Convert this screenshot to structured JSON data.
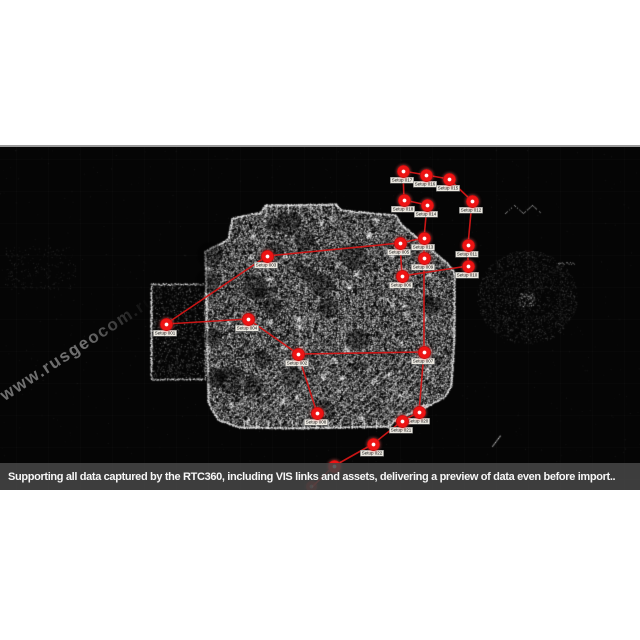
{
  "watermark": {
    "text": "www.rusgeocom.ru"
  },
  "caption": {
    "text": "Supporting all data captured by the RTC360, including VIS links and assets, delivering a preview of data even before import.."
  },
  "colors": {
    "node_red": "#ee1414",
    "link_red": "#d51717",
    "label_bg": "#ece9e1",
    "caption_bg": "#464646",
    "frame_bg": "#050505",
    "page_bg": "#ffffff"
  },
  "point_cloud_map": {
    "setups": [
      {
        "label": "Setup 017",
        "x": 403,
        "y": 171
      },
      {
        "label": "Setup 016",
        "x": 426,
        "y": 175
      },
      {
        "label": "Setup 015",
        "x": 449,
        "y": 179
      },
      {
        "label": "Setup 012",
        "x": 472,
        "y": 201
      },
      {
        "label": "Setup 018",
        "x": 404,
        "y": 200
      },
      {
        "label": "Setup 014",
        "x": 427,
        "y": 205
      },
      {
        "label": "Setup 013",
        "x": 424,
        "y": 238
      },
      {
        "label": "Setup 011",
        "x": 468,
        "y": 245
      },
      {
        "label": "Setup 010",
        "x": 468,
        "y": 266
      },
      {
        "label": "Setup 005",
        "x": 400,
        "y": 243
      },
      {
        "label": "Setup 009",
        "x": 424,
        "y": 258
      },
      {
        "label": "Setup 006",
        "x": 402,
        "y": 276
      },
      {
        "label": "Setup 003",
        "x": 267,
        "y": 256
      },
      {
        "label": "Setup 004",
        "x": 248,
        "y": 319
      },
      {
        "label": "Setup 001",
        "x": 166,
        "y": 324
      },
      {
        "label": "Setup 002",
        "x": 298,
        "y": 354
      },
      {
        "label": "Setup 007",
        "x": 424,
        "y": 352
      },
      {
        "label": "Setup 008",
        "x": 317,
        "y": 413
      },
      {
        "label": "Setup 020",
        "x": 419,
        "y": 412
      },
      {
        "label": "Setup 021",
        "x": 402,
        "y": 421
      },
      {
        "label": "Setup 022",
        "x": 373,
        "y": 444
      },
      {
        "label": "",
        "x": 334,
        "y": 466
      },
      {
        "label": "",
        "x": 312,
        "y": 487,
        "faint": true
      }
    ],
    "links": [
      [
        0,
        1
      ],
      [
        1,
        2
      ],
      [
        2,
        3
      ],
      [
        3,
        7
      ],
      [
        7,
        8
      ],
      [
        0,
        4
      ],
      [
        4,
        5
      ],
      [
        5,
        6
      ],
      [
        6,
        9
      ],
      [
        6,
        10
      ],
      [
        10,
        16
      ],
      [
        16,
        18
      ],
      [
        9,
        11
      ],
      [
        12,
        9
      ],
      [
        12,
        14
      ],
      [
        14,
        13
      ],
      [
        13,
        15
      ],
      [
        15,
        16
      ],
      [
        15,
        17
      ],
      [
        11,
        8
      ],
      [
        18,
        19
      ],
      [
        19,
        20
      ],
      [
        20,
        21
      ],
      [
        21,
        22
      ]
    ]
  }
}
